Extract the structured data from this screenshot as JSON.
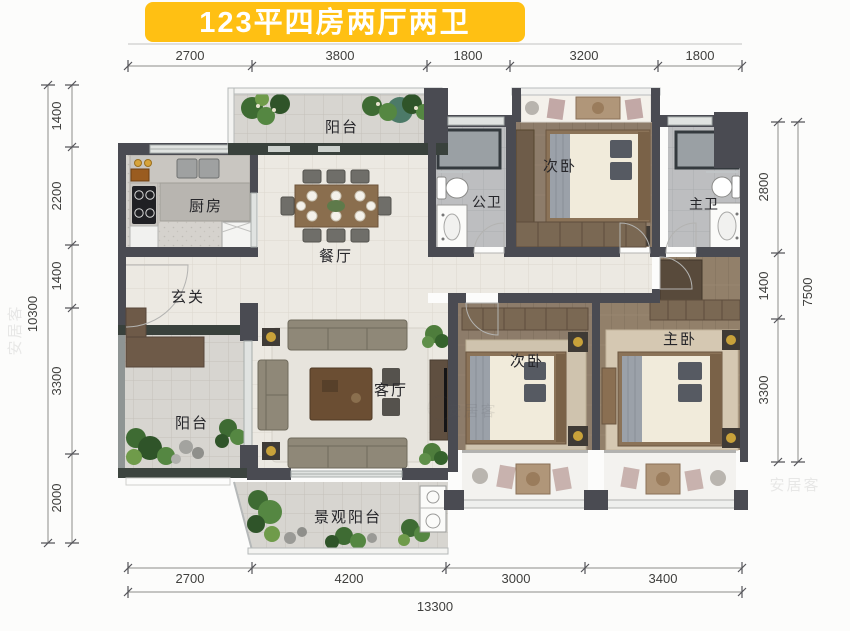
{
  "title": {
    "text": "123平四房两厅两卫"
  },
  "rooms": {
    "balcony_top": "阳台",
    "kitchen": "厨房",
    "dining": "餐厅",
    "guest_bath": "公卫",
    "bedroom_second_top": "次卧",
    "master_bath": "主卫",
    "foyer": "玄关",
    "balcony_side": "阳台",
    "living": "客厅",
    "bedroom_second_bottom": "次卧",
    "master_bedroom": "主卧",
    "landscape_balcony": "景观阳台"
  },
  "dimensions": {
    "top": [
      "2700",
      "3800",
      "1800",
      "3200",
      "1800"
    ],
    "bottom": [
      "2700",
      "4200",
      "3000",
      "3400"
    ],
    "bottom_total": "13300",
    "left": [
      "1400",
      "2200",
      "1400",
      "3300",
      "2000"
    ],
    "left_total": "10300",
    "right": [
      "2800",
      "1400",
      "3300"
    ],
    "right_total": "7500"
  },
  "watermark": "安居客",
  "colors": {
    "title_bg": "#ffc013",
    "title_text": "#ffffff",
    "wall": "#4a4b52",
    "dark_sill": "#39413c",
    "wood_floor": "#8d7c6a",
    "cream_floor": "#ece9e2",
    "bath_floor": "#bdbec0",
    "balcony_floor": "#d7d5d0",
    "plant_green": "#4e7d3c",
    "gold_accent": "#c9a23a"
  }
}
